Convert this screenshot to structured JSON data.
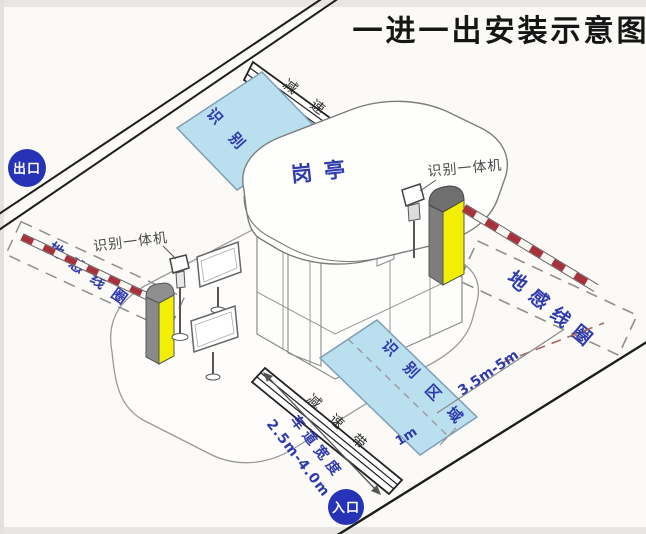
{
  "title": "一进一出安装示意图",
  "badges": {
    "exit": "出口",
    "entry": "入口"
  },
  "booth": {
    "label": "岗亭"
  },
  "devices": {
    "recognition_machine": "识别一体机"
  },
  "zones": {
    "ground_loop": "地感线圈",
    "recognition_area": "识别区域",
    "speed_bump": "减速带"
  },
  "dimensions": {
    "lane_width_label": "车道宽度",
    "lane_width_value": "2.5m-4.0m",
    "loop_distance": "3.5m-5m",
    "area_offset": "1m"
  },
  "colors": {
    "badge_blue": "#2733b6",
    "zone_blue_fill": "#badfee",
    "machine_yellow": "#f2ee06",
    "barrier_red": "#a8323c",
    "road_line": "#1c1c1c",
    "text_blue": "#2f3bad"
  }
}
